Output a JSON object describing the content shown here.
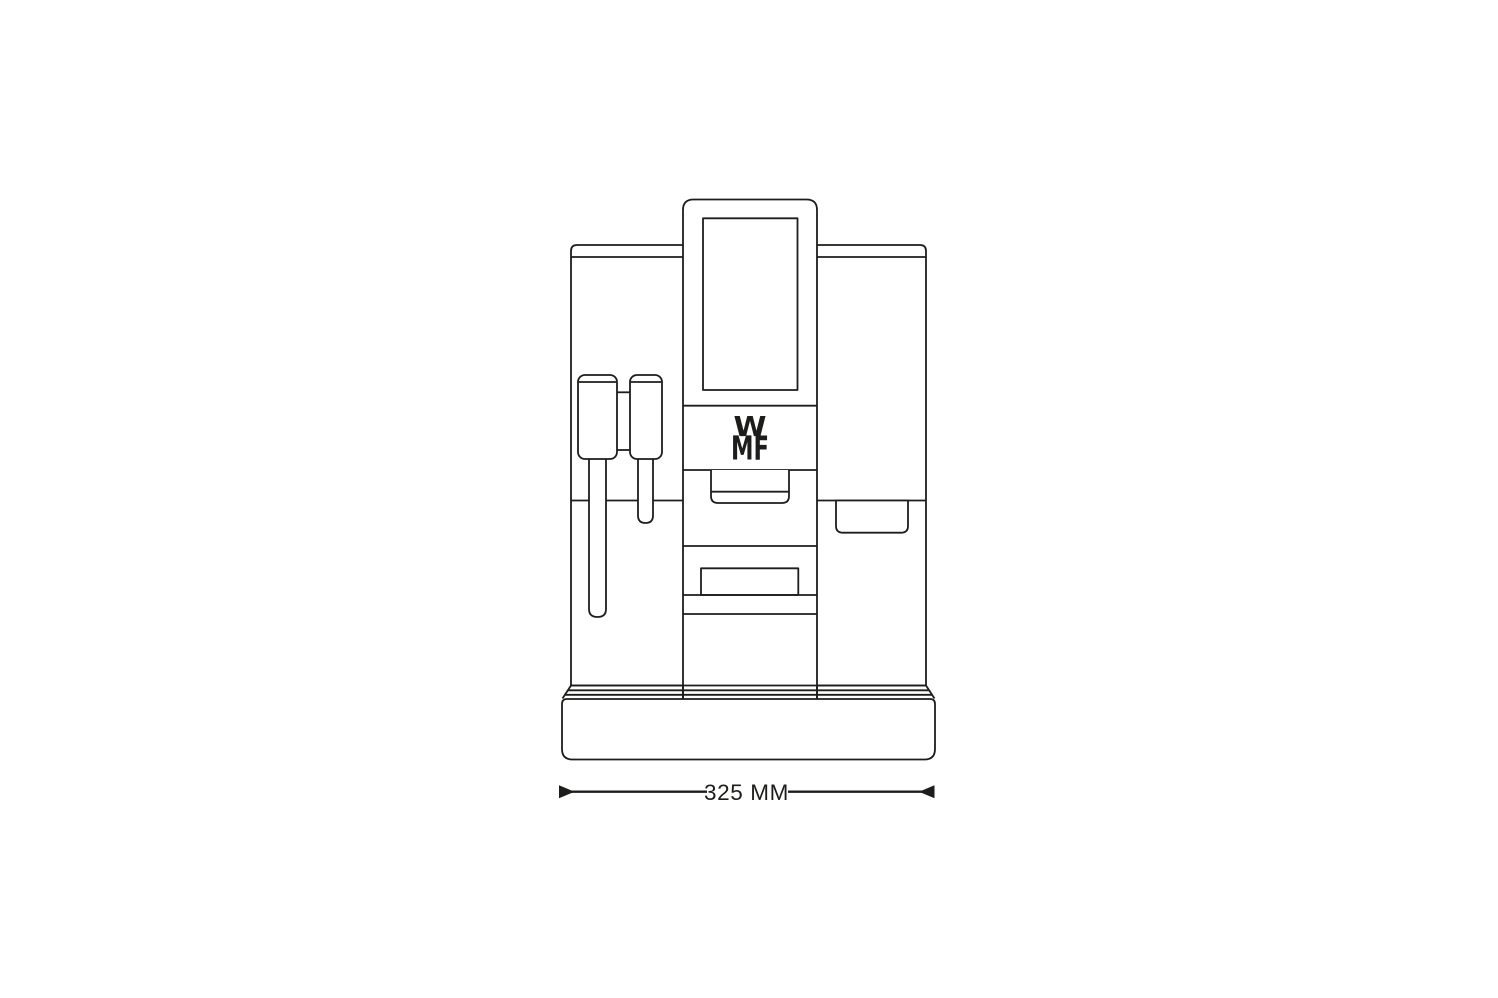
{
  "colors": {
    "line": "#1d1d1b",
    "background": "#ffffff"
  },
  "machine": {
    "brand_logo": {
      "top": "W",
      "bottom": "MF"
    }
  },
  "dimension": {
    "label": "325 MM"
  },
  "icons": {
    "dimension_arrow_left": "▶",
    "dimension_arrow_right": "◀"
  }
}
